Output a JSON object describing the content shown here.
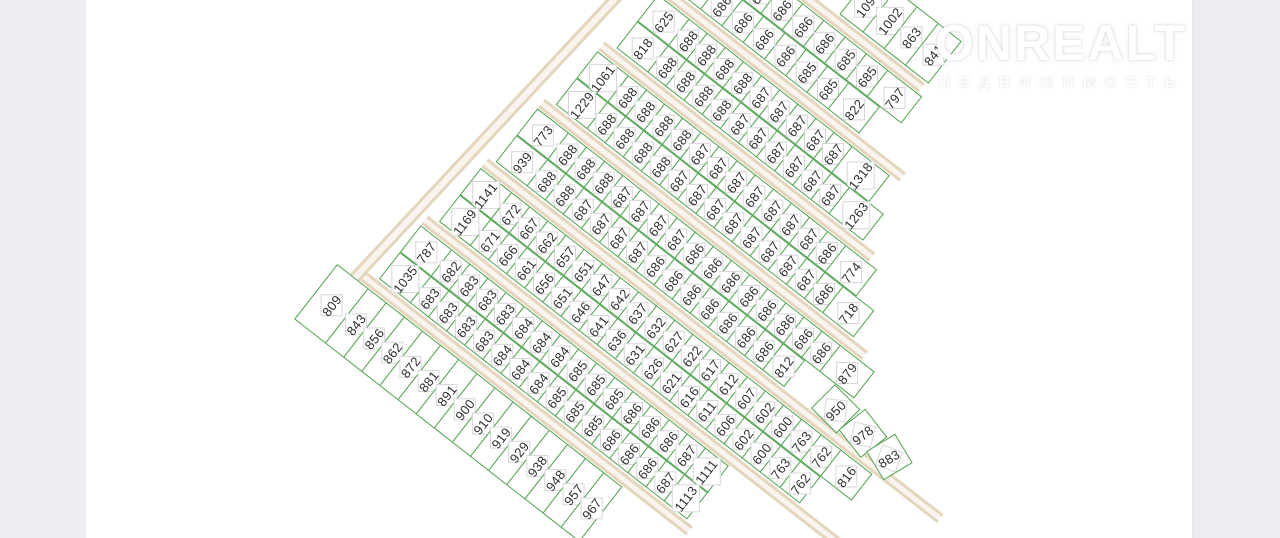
{
  "watermark": {
    "title": "ONREALT",
    "subtitle": "НЕДВИЖИМОСТЬ"
  },
  "map_colors": {
    "plot_line": "#4fa24f",
    "road_fill": "#f9f5ee",
    "road_edge": "#e4d6bd",
    "number_text": "#313131"
  },
  "strips": [
    {
      "id": "s1",
      "rows": [
        [
          "1091",
          "1002",
          "863",
          "841"
        ]
      ]
    },
    {
      "id": "s2",
      "rows": [
        [
          "686",
          "686",
          "686",
          "686",
          "685",
          "685",
          "797"
        ],
        [
          "10",
          "686",
          "686",
          "686",
          "686",
          "685",
          "685",
          "822"
        ]
      ]
    },
    {
      "id": "s3",
      "rows": [
        [
          "625",
          "688",
          "688",
          "688",
          "688",
          "687",
          "687",
          "687",
          "687",
          "687",
          "1318"
        ],
        [
          "818",
          "688",
          "688",
          "688",
          "688",
          "687",
          "687",
          "687",
          "687",
          "687",
          "687",
          "1263"
        ]
      ]
    },
    {
      "id": "s4",
      "rows": [
        [
          "1061",
          "688",
          "688",
          "688",
          "688",
          "687",
          "687",
          "687",
          "687",
          "687",
          "687",
          "687",
          "686",
          "774"
        ],
        [
          "1229",
          "688",
          "688",
          "688",
          "688",
          "687",
          "687",
          "687",
          "687",
          "687",
          "687",
          "687",
          "687",
          "686",
          "718"
        ]
      ]
    },
    {
      "id": "s5",
      "rows": [
        [
          "773",
          "688",
          "688",
          "688",
          "687",
          "687",
          "687",
          "687",
          "686",
          "686",
          "686",
          "686",
          "686",
          "686",
          "686",
          "686",
          "879"
        ],
        [
          "939",
          "688",
          "688",
          "687",
          "687",
          "687",
          "687",
          "686",
          "686",
          "686",
          "686",
          "686",
          "686",
          "686",
          "812",
          "950",
          "978",
          "883"
        ]
      ]
    },
    {
      "id": "s6",
      "rows": [
        [
          "1141",
          "672",
          "667",
          "662",
          "657",
          "651",
          "647",
          "642",
          "637",
          "632",
          "627",
          "622",
          "617",
          "612",
          "607",
          "602",
          "600",
          "763",
          "762",
          "816"
        ],
        [
          "1169",
          "671",
          "666",
          "661",
          "656",
          "651",
          "646",
          "641",
          "636",
          "631",
          "626",
          "621",
          "616",
          "611",
          "606",
          "602",
          "600",
          "763",
          "762"
        ]
      ]
    },
    {
      "id": "s7",
      "rows": [
        [
          "787",
          "682",
          "683",
          "683",
          "683",
          "684",
          "684",
          "684",
          "685",
          "685",
          "685",
          "686",
          "686",
          "686",
          "687",
          "1111"
        ],
        [
          "1035",
          "683",
          "683",
          "683",
          "683",
          "684",
          "684",
          "684",
          "685",
          "685",
          "685",
          "686",
          "686",
          "686",
          "687",
          "1113"
        ]
      ]
    },
    {
      "id": "s8",
      "rows": [
        [
          "809",
          "843",
          "856",
          "862",
          "872",
          "881",
          "891",
          "900",
          "910",
          "919",
          "929",
          "938",
          "948",
          "957",
          "967"
        ]
      ]
    }
  ]
}
